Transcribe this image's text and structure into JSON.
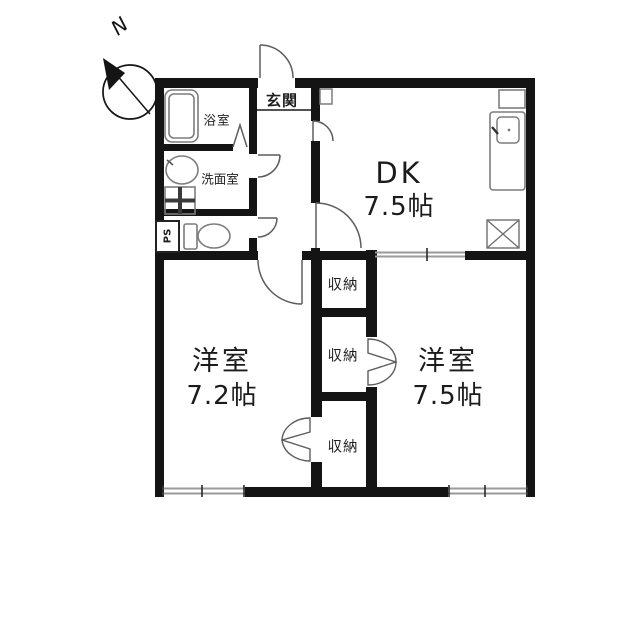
{
  "compass": {
    "north_label": "N"
  },
  "labels": {
    "genkan": "玄関",
    "bathroom": "浴室",
    "washroom": "洗面室",
    "pipe_space": "PS",
    "dk_name": "DK",
    "dk_size": "7.5帖",
    "room_left_name": "洋室",
    "room_left_size": "7.2帖",
    "room_right_name": "洋室",
    "room_right_size": "7.5帖",
    "storage_top": "収納",
    "storage_middle": "収納",
    "storage_bottom": "収納"
  },
  "icons": [
    "compass-north-icon",
    "bathtub-icon",
    "washbasin-icon",
    "washing-machine-icon",
    "toilet-icon",
    "bathroom-folding-door-icon",
    "kitchen-counter-icon",
    "kitchen-sink-icon",
    "refrigerator-space-icon",
    "cabinet-icon",
    "shoe-cabinet-icon",
    "door-swing-icon",
    "bifold-closet-door-icon",
    "sliding-window-icon",
    "sliding-door-icon"
  ],
  "colors": {
    "wall": "#141414",
    "fixture_line": "#7d7d7d",
    "door_line": "#5d5d5d",
    "window_line": "#9a9a9a",
    "text": "#1e1e1e",
    "background": "#ffffff"
  }
}
